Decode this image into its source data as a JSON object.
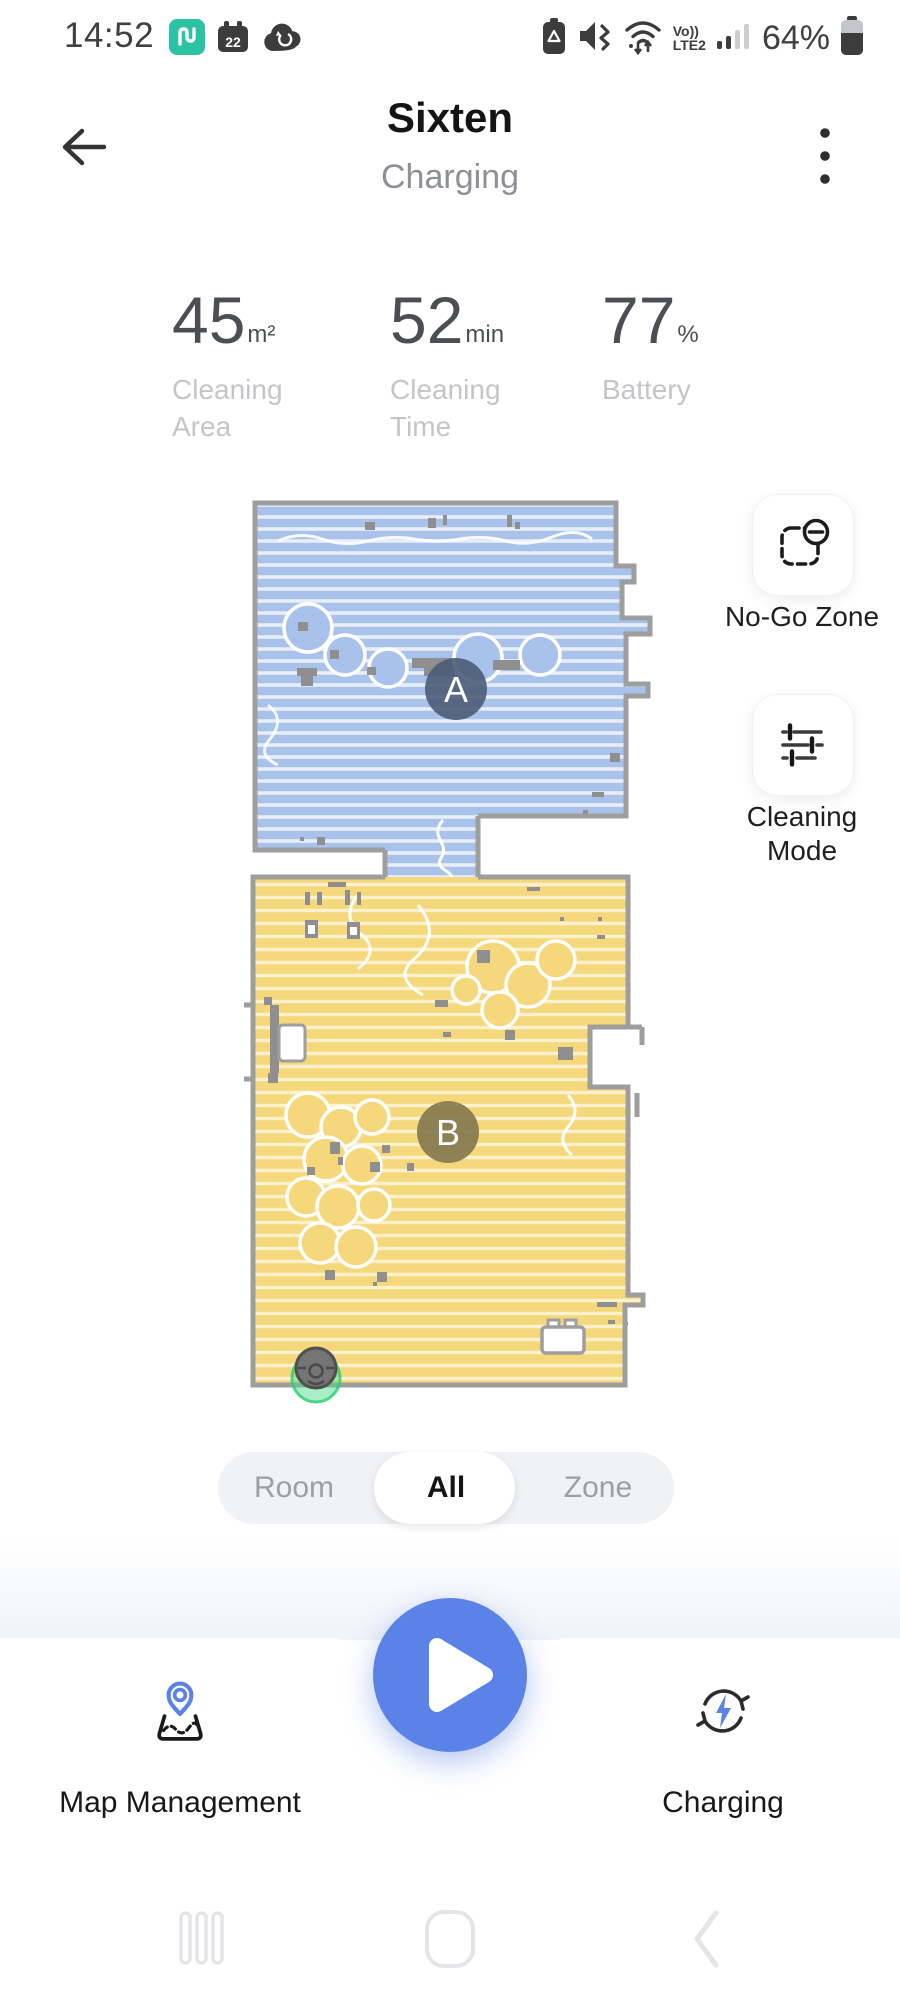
{
  "status_bar": {
    "time": "14:52",
    "calendar_day": "22",
    "volte_line1": "Vo))",
    "volte_line2": "LTE2",
    "battery_percent": "64%"
  },
  "header": {
    "title": "Sixten",
    "status": "Charging"
  },
  "stats": {
    "area": {
      "value": "45",
      "unit": "m²",
      "label": "Cleaning Area"
    },
    "time": {
      "value": "52",
      "unit": "min",
      "label": "Cleaning Time"
    },
    "battery": {
      "value": "77",
      "unit": "%",
      "label": "Battery"
    }
  },
  "map": {
    "room_a_label": "A",
    "room_b_label": "B",
    "colors": {
      "room_a_fill": "#A9C2EB",
      "room_b_fill": "#F6D87C",
      "wall": "#9E9E9E",
      "dock_green": "#3DDC84"
    }
  },
  "side_actions": {
    "no_go_zone": "No-Go Zone",
    "cleaning_mode": "Cleaning Mode"
  },
  "mode_switch": {
    "options": [
      "Room",
      "All",
      "Zone"
    ],
    "selected": "All"
  },
  "bottom_bar": {
    "map_management": "Map Management",
    "charging": "Charging"
  },
  "accent_color": "#5B82E6"
}
